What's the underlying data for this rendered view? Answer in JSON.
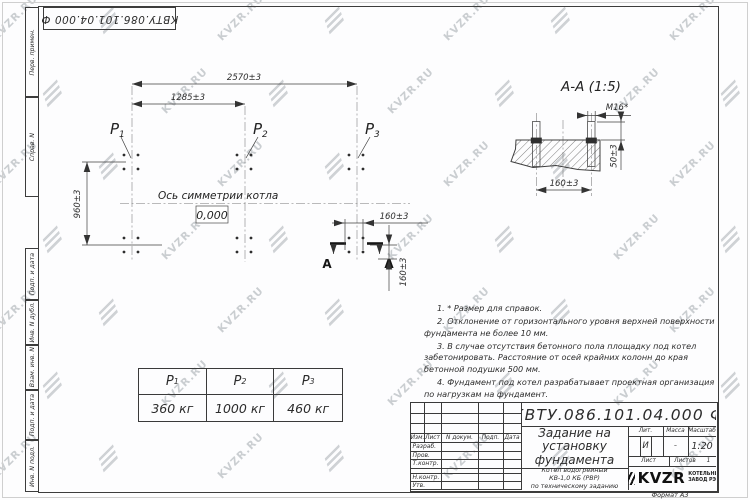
{
  "page": {
    "watermark_text": "KVZR.RU",
    "format_label": "Формат А3",
    "colors": {
      "line": "#3c3c3c",
      "text": "#2c2c2c",
      "watermark": "#b0b5ba"
    }
  },
  "top_stamp": {
    "doc_number_rotated": "КВТУ.086.101.04.000  Ф"
  },
  "margin_labels": {
    "items": [
      "Перв. примен.",
      "Справ. N",
      "Подп. и дата",
      "Инв. N дубл.",
      "Взам. инв. N",
      "Подп. и дата",
      "Инв. N подл."
    ]
  },
  "plan": {
    "dim_width_total": "2570±3",
    "dim_width_half": "1285±3",
    "dim_depth": "960±3",
    "dim_bolt_spacing_h": "160±3",
    "dim_bolt_spacing_v": "160±3",
    "axis_label": "Ось симметрии котла",
    "level_mark": "0,000",
    "load_symbol": "P",
    "p1_sub": "1",
    "p2_sub": "2",
    "p3_sub": "3",
    "section_letter_left": "А",
    "section_letter_right": "А"
  },
  "section_view": {
    "title": "А-А (1:5)",
    "thread_label": "M16*",
    "dim_protrusion": "50±3",
    "dim_spacing": "160±3"
  },
  "load_table": {
    "header_symbol": "P",
    "subscripts": [
      "1",
      "2",
      "3"
    ],
    "values": [
      "360 кг",
      "1000 кг",
      "460 кг"
    ]
  },
  "notes": {
    "items": [
      "1. * Размер для справок.",
      "2. Отклонение от горизонтального уровня верхней поверхности фундамента не более 10 мм.",
      "3. В случае отсутствия бетонного пола площадку под котел забетонировать. Расстояние от осей крайних колонн до края бетонной подушки 500 мм.",
      "4. Фундамент под котел разрабатывает проектная организация по нагрузкам на фундамент."
    ]
  },
  "title_block": {
    "doc_number": "КВТУ.086.101.04.000  Ф",
    "title": "Задание на установку фундамента",
    "subtitle_lines": [
      "Котел водогрейный",
      "КВ-1,0 КБ (РВР)",
      "по техническому заданию"
    ],
    "columns": [
      "Изм.",
      "Лист",
      "N докум.",
      "Подп.",
      "Дата"
    ],
    "rows": [
      "Разраб.",
      "Пров.",
      "Т.контр.",
      "Н.контр.",
      "Утв."
    ],
    "lit_label": "Лит.",
    "lit_value": "И",
    "mass_label": "Масса",
    "mass_value": "–",
    "scale_label": "Масштаб",
    "scale_value": "1:20",
    "sheet_label": "Лист",
    "sheets_label": "Листов",
    "sheets_value": "1",
    "company_name": "KVZR",
    "company_line1": "КОТЕЛЬНЫЙ",
    "company_line2": "ЗАВОД РЭП"
  }
}
